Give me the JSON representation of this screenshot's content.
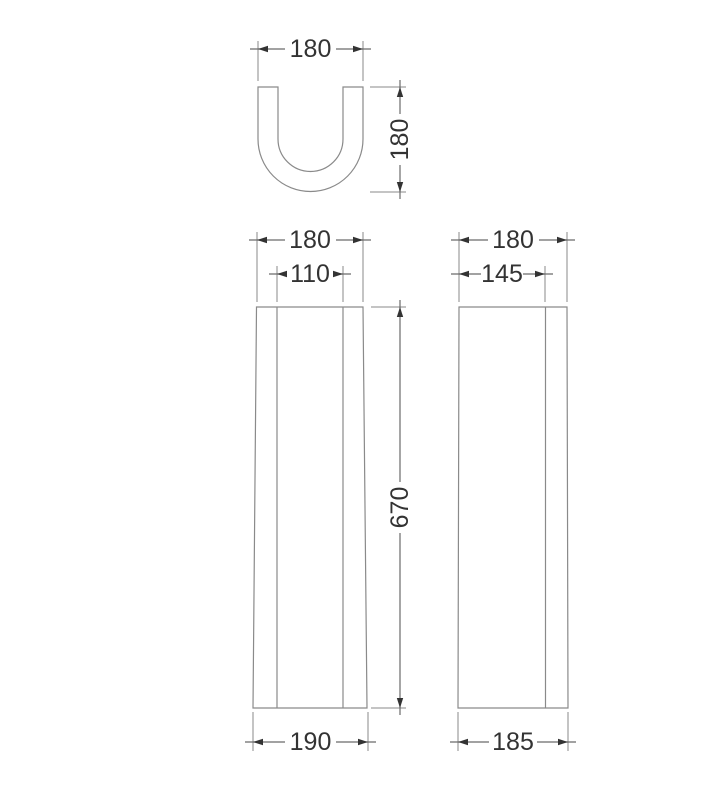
{
  "colors": {
    "background": "#ffffff",
    "line": "#8a8a8a",
    "dim_line": "#6a6a6a",
    "text": "#333333"
  },
  "views": {
    "top": {
      "width_label": "180",
      "depth_label": "180"
    },
    "front": {
      "top_width_label": "180",
      "recess_width_label": "110",
      "height_label": "670",
      "base_width_label": "190"
    },
    "side": {
      "top_width_label": "180",
      "panel_width_label": "145",
      "base_width_label": "185"
    }
  }
}
